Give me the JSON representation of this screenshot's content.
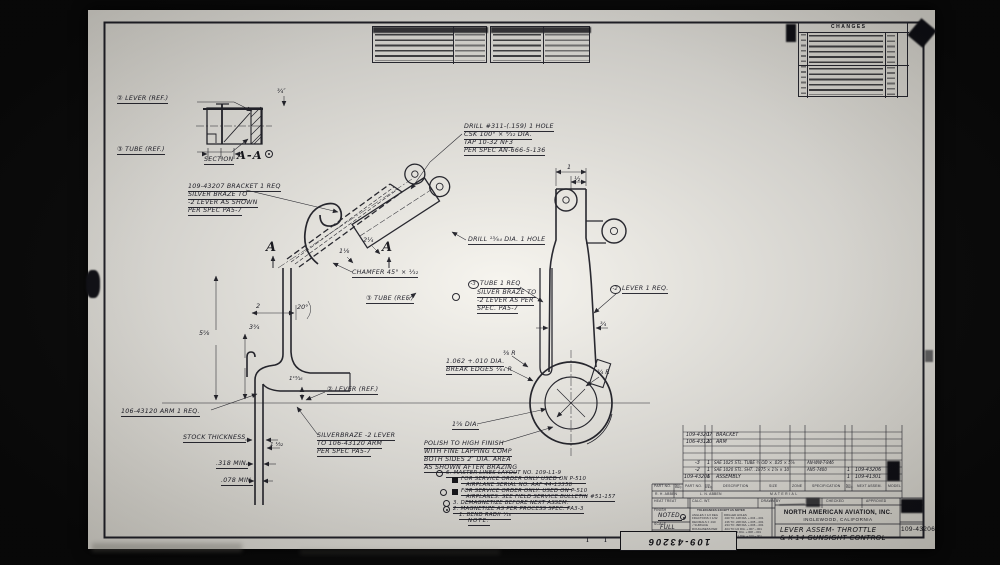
{
  "changes": {
    "title": "CHANGES"
  },
  "section_aa": {
    "lever_ref": "② LEVER (REF.)",
    "tube_ref": "③ TUBE (REF.)",
    "dim": "¾″",
    "label": "SECTION",
    "name": "A-A"
  },
  "callouts": {
    "drill_tap_1": "DRILL #311-(.159) 1 HOLE",
    "drill_tap_2": "CSK 100° × ⁹⁄₃₂ DIA.",
    "drill_tap_3": "TAP 10-32 NF3",
    "drill_tap_4": "PER SPEC AN-666-5-136",
    "drill_hole": "DRILL ¹³⁄₆₄ DIA. 1 HOLE",
    "bracket_1": "109-43207 BRACKET 1 REQ",
    "bracket_2": "SILVER BRAZE TO",
    "bracket_3": "-2 LEVER AS SHOWN",
    "bracket_4": "PER SPEC PA5-7",
    "chamfer": "CHAMFER 45° × ¹⁄₃₂",
    "tube_ref": "③ TUBE (REF.)",
    "tube_mark": "-3",
    "tube_1": "TUBE 1 REQ",
    "tube_2": "SILVER BRAZE TO",
    "tube_3": "-2 LEVER AS PER",
    "tube_4": "SPEC. PA5-7",
    "lever_mark": "-2",
    "lever_1": "LEVER 1 REQ.",
    "arm": "106-43120 ARM 1 REQ.",
    "stock": "STOCK THICKNESS",
    "min318": ".318 MIN.",
    "min078": ".078 MIN.",
    "braze_1": "SILVERBRAZE -2 LEVER",
    "braze_2": "TO 106-43120 ARM",
    "braze_3": "PER SPEC PA5-7",
    "bore_1": "1.062 +.010 DIA.",
    "bore_2": "BREAK EDGES ¹⁄₆₄ R",
    "polish_1": "POLISH TO HIGH FINISH",
    "polish_2": "WITH FINE LAPPING COMP",
    "polish_3": "BOTH SIDES 2″ DIA. AREA",
    "polish_4": "AS SHOWN AFTER BRAZING",
    "dia158": "1⅝ DIA.",
    "lever_ref": "② LEVER (REF.)"
  },
  "dims": {
    "two": "2",
    "twenty": "20°",
    "five58": "5⅝",
    "three34": "3¾",
    "one1316": "1¹³⁄₁₆",
    "one132": "1 ¹⁄₃₂",
    "one": "1",
    "half": "½",
    "threequarter": "¾",
    "r38": "⅜ R",
    "r34": "¾ R",
    "two14": "2¼",
    "one18": "1⅛"
  },
  "markers": {
    "a_left": "A",
    "a_right": "A"
  },
  "notes": {
    "n6": "6. MASTER LINES LAYOUT NO. 109-L1-9",
    "n5a": "FOR SERVICE ORDER ONLY USED ON P-510",
    "n5b": "AIRPLANE SERIAL NO. AAF 44-13358",
    "n4a": "FOR SERVICE ORDER ONLY. USED ON P-510",
    "n4b": "AIRPLANES. SEE FIELD SERVICE BULLETIN #51-157",
    "n3": "3. DEMAGNETIZE BEFORE NEXT ASSEM.",
    "n2": "2. MAGNETIZE AS PER PROCESS SPEC. PA3-3",
    "n1": "1. BEND RADII ¹⁄₁₆",
    "title": "NOTE:"
  },
  "parts": {
    "r1_part": "109-43207",
    "r1_req": "1",
    "r1_desc": "BRACKET",
    "r2_part": "106-43120",
    "r2_req": "1",
    "r2_desc": "ARM",
    "r3_part": "-3",
    "r3_req": "1",
    "r3_desc": "SAE 1025 STL. TUBE ¾ OD × .035 × 5⅞",
    "r3_spec": "AN-WW-T-846",
    "r4_part": "-2",
    "r4_req": "1",
    "r4_desc": "SAE 1020 STL. SHT. .1875 × 1⅞ × 10",
    "r4_spec": "AN5-7400",
    "r5_part": "109-43206",
    "r5_req": "1",
    "r5_desc": "ASSEMBLY",
    "h_part": "PART NO.",
    "h_req": "NO. REQ.",
    "h_desc": "DESCRIPTION",
    "h_size": "SIZE",
    "h_zone": "ZONE",
    "h_spec": "SPECIFICATION",
    "h_next": "NEXT ASSEM.",
    "h_model": "MODEL",
    "next1": "1",
    "next1_no": "109-43206",
    "next2": "1",
    "next2_no": "109-41301",
    "material": "MATERIAL",
    "sig1": "R. H. ABBEN",
    "sig2": "L. N. ABBEN"
  },
  "titleblock": {
    "heat": "HEAT TREAT",
    "calc": "CALC. WT.",
    "drawn": "DRAWN BY",
    "checked": "CHECKED",
    "approved": "APPROVED",
    "tol_title": "TOLERANCES EXCEPT AS NOTED",
    "t1a": "ANGLES ± 1/2 DEG",
    "t1b": "DRILLED HOLES",
    "t2a": "FRACTIONS ± 1/32",
    "t2b": ".040 TO .128 DIA. +.004 −.001",
    "t3a": "DECIMALS ± .010",
    "t3b": ".136 TO .228 DIA. +.005 −.001",
    "t4a": "√ SURFACE",
    "t4b": ".234 TO .398 DIA. +.006 −.001",
    "t5a": "ROUGHNESS PER",
    "t5b": ".404 TO 1/2 DIA. +.007 −.001",
    "t6a": "NATL. AIRCRAFT",
    "t6b": "17/32 TO 1 DIA. +.008 −.001",
    "t7a": "STANDARDS 290",
    "t7b": "1 1/64 TO 2 DIA. +.010 −.001",
    "finish": "FINISH",
    "finish_v": "NOTED.",
    "scale": "SCALE",
    "scale_v": "FULL",
    "company": "NORTH AMERICAN AVIATION, INC.",
    "location": "INGLEWOOD,  CALIFORNIA",
    "title1": "LEVER ASSEM- THROTTLE",
    "title2": "& K-14 GUNSIGHT CONTROL",
    "number": "109-43206",
    "stamp": "109-43206",
    "roman1": "I",
    "roman2": "I"
  }
}
